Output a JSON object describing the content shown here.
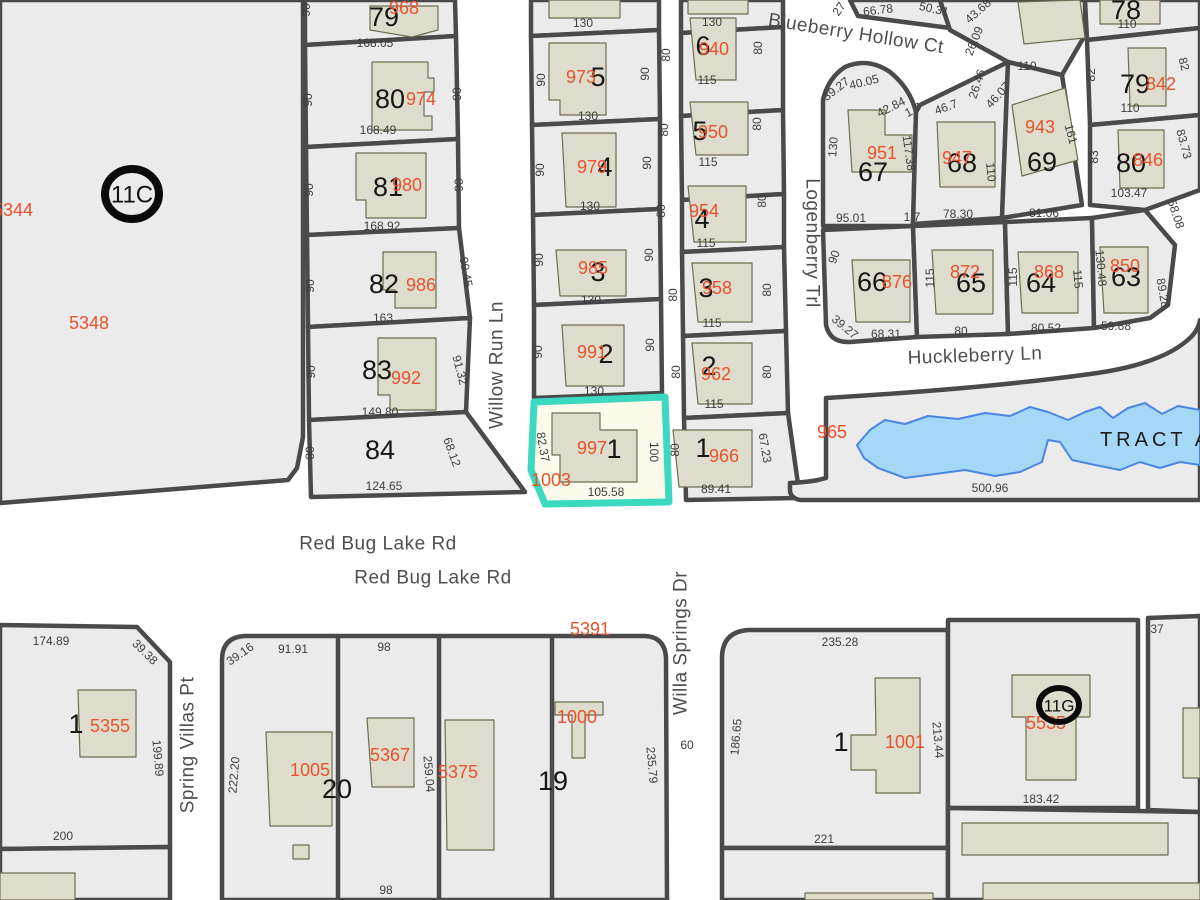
{
  "map": {
    "colors": {
      "parcel_fill": "#ebebeb",
      "road": "#ffffff",
      "boundary": "#4a4a4a",
      "building_fill": "#deddcd",
      "water_fill": "#a5d8f6",
      "water_stroke": "#4b86e0",
      "highlight_stroke": "#3cd9c1",
      "highlight_fill": "#fcfaeb",
      "apn_red": "#e9512d"
    },
    "streets": [
      {
        "t": "Willow Run Ln",
        "x": 497,
        "y": 365,
        "r": -90
      },
      {
        "t": "Blueberry Hollow Ct",
        "x": 856,
        "y": 34,
        "r": 9
      },
      {
        "t": "Logenberry Trl",
        "x": 812,
        "y": 243,
        "r": 90
      },
      {
        "t": "Huckleberry Ln",
        "x": 975,
        "y": 356,
        "r": -2
      },
      {
        "t": "Red Bug Lake Rd",
        "x": 378,
        "y": 544,
        "r": 0
      },
      {
        "t": "Red Bug Lake Rd",
        "x": 433,
        "y": 578,
        "r": 0
      },
      {
        "t": "Spring Villas Pt",
        "x": 188,
        "y": 745,
        "r": -90
      },
      {
        "t": "Willa Springs Dr",
        "x": 681,
        "y": 643,
        "r": -90
      }
    ],
    "areas": [
      {
        "t": "TRACT A",
        "x": 1156,
        "y": 440,
        "r": 0
      }
    ],
    "lots": [
      {
        "t": "79",
        "x": 384,
        "y": 17
      },
      {
        "t": "80",
        "x": 390,
        "y": 99
      },
      {
        "t": "81",
        "x": 388,
        "y": 187
      },
      {
        "t": "82",
        "x": 384,
        "y": 284
      },
      {
        "t": "83",
        "x": 377,
        "y": 370
      },
      {
        "t": "84",
        "x": 380,
        "y": 450
      },
      {
        "t": "5",
        "x": 598,
        "y": 77
      },
      {
        "t": "4",
        "x": 605,
        "y": 167
      },
      {
        "t": "3",
        "x": 598,
        "y": 272
      },
      {
        "t": "2",
        "x": 606,
        "y": 354
      },
      {
        "t": "1",
        "x": 614,
        "y": 449
      },
      {
        "t": "6",
        "x": 703,
        "y": 46
      },
      {
        "t": "5",
        "x": 700,
        "y": 131
      },
      {
        "t": "4",
        "x": 702,
        "y": 219
      },
      {
        "t": "3",
        "x": 706,
        "y": 288
      },
      {
        "t": "2",
        "x": 709,
        "y": 366
      },
      {
        "t": "1",
        "x": 703,
        "y": 448
      },
      {
        "t": "67",
        "x": 873,
        "y": 172
      },
      {
        "t": "68",
        "x": 962,
        "y": 163
      },
      {
        "t": "69",
        "x": 1042,
        "y": 162
      },
      {
        "t": "66",
        "x": 872,
        "y": 282
      },
      {
        "t": "65",
        "x": 971,
        "y": 283
      },
      {
        "t": "64",
        "x": 1041,
        "y": 283
      },
      {
        "t": "63",
        "x": 1126,
        "y": 277
      },
      {
        "t": "78",
        "x": 1126,
        "y": 10
      },
      {
        "t": "79",
        "x": 1135,
        "y": 84
      },
      {
        "t": "80",
        "x": 1131,
        "y": 163
      },
      {
        "t": "1",
        "x": 76,
        "y": 724
      },
      {
        "t": "20",
        "x": 337,
        "y": 789
      },
      {
        "t": "19",
        "x": 553,
        "y": 781
      },
      {
        "t": "1",
        "x": 841,
        "y": 742
      }
    ],
    "apns": [
      {
        "t": "968",
        "x": 404,
        "y": 8
      },
      {
        "t": "974",
        "x": 421,
        "y": 99
      },
      {
        "t": "980",
        "x": 407,
        "y": 185
      },
      {
        "t": "986",
        "x": 421,
        "y": 285
      },
      {
        "t": "992",
        "x": 406,
        "y": 378
      },
      {
        "t": "973",
        "x": 581,
        "y": 77
      },
      {
        "t": "979",
        "x": 592,
        "y": 167
      },
      {
        "t": "985",
        "x": 593,
        "y": 268
      },
      {
        "t": "991",
        "x": 592,
        "y": 352
      },
      {
        "t": "997",
        "x": 592,
        "y": 448
      },
      {
        "t": "1003",
        "x": 551,
        "y": 480
      },
      {
        "t": "940",
        "x": 714,
        "y": 49
      },
      {
        "t": "950",
        "x": 713,
        "y": 132
      },
      {
        "t": "954",
        "x": 704,
        "y": 211
      },
      {
        "t": "958",
        "x": 717,
        "y": 288
      },
      {
        "t": "962",
        "x": 716,
        "y": 374
      },
      {
        "t": "966",
        "x": 724,
        "y": 456
      },
      {
        "t": "951",
        "x": 882,
        "y": 153
      },
      {
        "t": "947",
        "x": 957,
        "y": 158
      },
      {
        "t": "943",
        "x": 1040,
        "y": 127
      },
      {
        "t": "842",
        "x": 1161,
        "y": 84
      },
      {
        "t": "846",
        "x": 1148,
        "y": 160
      },
      {
        "t": "876",
        "x": 897,
        "y": 282
      },
      {
        "t": "872",
        "x": 965,
        "y": 272
      },
      {
        "t": "868",
        "x": 1049,
        "y": 272
      },
      {
        "t": "850",
        "x": 1125,
        "y": 266
      },
      {
        "t": "965",
        "x": 832,
        "y": 432
      },
      {
        "t": "5344",
        "x": 13,
        "y": 210
      },
      {
        "t": "5348",
        "x": 89,
        "y": 323
      },
      {
        "t": "5355",
        "x": 110,
        "y": 726
      },
      {
        "t": "1005",
        "x": 310,
        "y": 770
      },
      {
        "t": "5367",
        "x": 390,
        "y": 755
      },
      {
        "t": "5375",
        "x": 458,
        "y": 772
      },
      {
        "t": "1000",
        "x": 577,
        "y": 717
      },
      {
        "t": "5391",
        "x": 590,
        "y": 629
      },
      {
        "t": "1001",
        "x": 905,
        "y": 742
      },
      {
        "t": "5535",
        "x": 1046,
        "y": 723
      }
    ],
    "dims": [
      {
        "t": "90",
        "x": 306,
        "y": 10,
        "r": -90
      },
      {
        "t": "168.05",
        "x": 375,
        "y": 43
      },
      {
        "t": "90",
        "x": 308,
        "y": 100,
        "r": -90
      },
      {
        "t": "90",
        "x": 457,
        "y": 94,
        "r": -90
      },
      {
        "t": "168.49",
        "x": 378,
        "y": 130
      },
      {
        "t": "90",
        "x": 309,
        "y": 190,
        "r": -90
      },
      {
        "t": "90",
        "x": 459,
        "y": 185,
        "r": -90
      },
      {
        "t": "168.92",
        "x": 382,
        "y": 226
      },
      {
        "t": "90",
        "x": 310,
        "y": 286,
        "r": -90
      },
      {
        "t": "90.45",
        "x": 466,
        "y": 272,
        "r": 80
      },
      {
        "t": "163",
        "x": 383,
        "y": 318
      },
      {
        "t": "90",
        "x": 311,
        "y": 372,
        "r": -90
      },
      {
        "t": "91.32",
        "x": 460,
        "y": 370,
        "r": 75
      },
      {
        "t": "149.80",
        "x": 380,
        "y": 412
      },
      {
        "t": "80",
        "x": 310,
        "y": 453,
        "r": -90
      },
      {
        "t": "68.12",
        "x": 452,
        "y": 452,
        "r": 70
      },
      {
        "t": "124.65",
        "x": 384,
        "y": 486
      },
      {
        "t": "130",
        "x": 583,
        "y": 23
      },
      {
        "t": "90",
        "x": 541,
        "y": 80,
        "r": -90
      },
      {
        "t": "90",
        "x": 645,
        "y": 74,
        "r": -90
      },
      {
        "t": "130",
        "x": 588,
        "y": 116
      },
      {
        "t": "90",
        "x": 540,
        "y": 170,
        "r": -90
      },
      {
        "t": "90",
        "x": 647,
        "y": 163,
        "r": -90
      },
      {
        "t": "130",
        "x": 590,
        "y": 206
      },
      {
        "t": "90",
        "x": 539,
        "y": 260,
        "r": -90
      },
      {
        "t": "90",
        "x": 649,
        "y": 255,
        "r": -90
      },
      {
        "t": "130",
        "x": 591,
        "y": 300
      },
      {
        "t": "90",
        "x": 538,
        "y": 352,
        "r": -90
      },
      {
        "t": "90",
        "x": 650,
        "y": 345,
        "r": -90
      },
      {
        "t": "130",
        "x": 594,
        "y": 391
      },
      {
        "t": "82.37",
        "x": 543,
        "y": 447,
        "r": 80
      },
      {
        "t": "100",
        "x": 654,
        "y": 452,
        "r": 90
      },
      {
        "t": "105.58",
        "x": 606,
        "y": 492
      },
      {
        "t": "130",
        "x": 712,
        "y": 22
      },
      {
        "t": "80",
        "x": 666,
        "y": 55,
        "r": -90
      },
      {
        "t": "80",
        "x": 758,
        "y": 48,
        "r": -90
      },
      {
        "t": "115",
        "x": 707,
        "y": 80
      },
      {
        "t": "80",
        "x": 664,
        "y": 130,
        "r": -90
      },
      {
        "t": "80",
        "x": 757,
        "y": 124,
        "r": -90
      },
      {
        "t": "115",
        "x": 708,
        "y": 162
      },
      {
        "t": "80",
        "x": 661,
        "y": 211,
        "r": -90
      },
      {
        "t": "80",
        "x": 762,
        "y": 201,
        "r": -90
      },
      {
        "t": "115",
        "x": 706,
        "y": 243
      },
      {
        "t": "80",
        "x": 673,
        "y": 295,
        "r": -90
      },
      {
        "t": "80",
        "x": 767,
        "y": 290,
        "r": -90
      },
      {
        "t": "115",
        "x": 712,
        "y": 323
      },
      {
        "t": "80",
        "x": 676,
        "y": 372,
        "r": -90
      },
      {
        "t": "80",
        "x": 767,
        "y": 372,
        "r": -90
      },
      {
        "t": "115",
        "x": 714,
        "y": 404
      },
      {
        "t": "80",
        "x": 675,
        "y": 450,
        "r": -90
      },
      {
        "t": "67.23",
        "x": 765,
        "y": 448,
        "r": 80
      },
      {
        "t": "89.41",
        "x": 716,
        "y": 489
      },
      {
        "t": "27",
        "x": 839,
        "y": 9,
        "r": -55
      },
      {
        "t": "66.78",
        "x": 878,
        "y": 10,
        "r": -7
      },
      {
        "t": "50.31",
        "x": 934,
        "y": 9,
        "r": 12
      },
      {
        "t": "43.68",
        "x": 978,
        "y": 11,
        "r": -42
      },
      {
        "t": "26.09",
        "x": 974,
        "y": 41,
        "r": -68
      },
      {
        "t": "26.46",
        "x": 977,
        "y": 84,
        "r": -72
      },
      {
        "t": "46.07",
        "x": 998,
        "y": 95,
        "r": -48
      },
      {
        "t": "46.7",
        "x": 946,
        "y": 107,
        "r": -20
      },
      {
        "t": "39.27",
        "x": 836,
        "y": 89,
        "r": -38
      },
      {
        "t": "40.05",
        "x": 864,
        "y": 82,
        "r": -14
      },
      {
        "t": "42.84",
        "x": 891,
        "y": 107,
        "r": -27
      },
      {
        "t": "1.7",
        "x": 913,
        "y": 110,
        "r": -27
      },
      {
        "t": "130",
        "x": 833,
        "y": 147,
        "r": -85
      },
      {
        "t": "117.38",
        "x": 909,
        "y": 153,
        "r": 82
      },
      {
        "t": "95.01",
        "x": 851,
        "y": 218
      },
      {
        "t": "1.7",
        "x": 912,
        "y": 217
      },
      {
        "t": "78.30",
        "x": 958,
        "y": 214
      },
      {
        "t": "110",
        "x": 991,
        "y": 172,
        "r": 85
      },
      {
        "t": "110",
        "x": 1027,
        "y": 66
      },
      {
        "t": "161",
        "x": 1071,
        "y": 134,
        "r": 75
      },
      {
        "t": "81.06",
        "x": 1044,
        "y": 213
      },
      {
        "t": "110",
        "x": 1127,
        "y": 24
      },
      {
        "t": "82",
        "x": 1091,
        "y": 75,
        "r": -90
      },
      {
        "t": "82",
        "x": 1184,
        "y": 64,
        "r": 75
      },
      {
        "t": "110",
        "x": 1130,
        "y": 108
      },
      {
        "t": "83",
        "x": 1094,
        "y": 157,
        "r": -90
      },
      {
        "t": "83.73",
        "x": 1184,
        "y": 144,
        "r": 75
      },
      {
        "t": "103.47",
        "x": 1129,
        "y": 193
      },
      {
        "t": "58.08",
        "x": 1176,
        "y": 214,
        "r": 72
      },
      {
        "t": "130.48",
        "x": 1101,
        "y": 268,
        "r": 85
      },
      {
        "t": "89.28",
        "x": 1163,
        "y": 293,
        "r": 80
      },
      {
        "t": "59.88",
        "x": 1116,
        "y": 326
      },
      {
        "t": "90",
        "x": 834,
        "y": 257,
        "r": -70
      },
      {
        "t": "39.27",
        "x": 845,
        "y": 327,
        "r": 40
      },
      {
        "t": "68.31",
        "x": 886,
        "y": 334
      },
      {
        "t": "115",
        "x": 930,
        "y": 278,
        "r": -90
      },
      {
        "t": "80",
        "x": 961,
        "y": 331
      },
      {
        "t": "115",
        "x": 1013,
        "y": 277,
        "r": -90
      },
      {
        "t": "115",
        "x": 1078,
        "y": 279,
        "r": 85
      },
      {
        "t": "80.52",
        "x": 1046,
        "y": 328
      },
      {
        "t": "500.96",
        "x": 990,
        "y": 488
      },
      {
        "t": "174.89",
        "x": 51,
        "y": 641
      },
      {
        "t": "39.38",
        "x": 145,
        "y": 652,
        "r": 45
      },
      {
        "t": "199.89",
        "x": 158,
        "y": 758,
        "r": 85
      },
      {
        "t": "200",
        "x": 63,
        "y": 836
      },
      {
        "t": "39.16",
        "x": 240,
        "y": 654,
        "r": -35
      },
      {
        "t": "91.91",
        "x": 293,
        "y": 649
      },
      {
        "t": "222.20",
        "x": 234,
        "y": 775,
        "r": -85
      },
      {
        "t": "98",
        "x": 384,
        "y": 647
      },
      {
        "t": "259.04",
        "x": 429,
        "y": 774,
        "r": 85
      },
      {
        "t": "98",
        "x": 386,
        "y": 890
      },
      {
        "t": "235.79",
        "x": 652,
        "y": 765,
        "r": 85
      },
      {
        "t": "60",
        "x": 687,
        "y": 745
      },
      {
        "t": "235.28",
        "x": 840,
        "y": 642
      },
      {
        "t": "186.65",
        "x": 736,
        "y": 737,
        "r": -85
      },
      {
        "t": "213.44",
        "x": 938,
        "y": 740,
        "r": 85
      },
      {
        "t": "221",
        "x": 824,
        "y": 839
      },
      {
        "t": "183.42",
        "x": 1041,
        "y": 799
      },
      {
        "t": "37",
        "x": 1157,
        "y": 629
      }
    ],
    "circles": [
      {
        "t": "11C",
        "x": 132,
        "y": 194,
        "rx": 27,
        "ry": 25,
        "sw": 8,
        "fs": 24
      },
      {
        "t": "11G",
        "x": 1059,
        "y": 705,
        "rx": 20,
        "ry": 17,
        "sw": 6,
        "fs": 17
      }
    ]
  }
}
